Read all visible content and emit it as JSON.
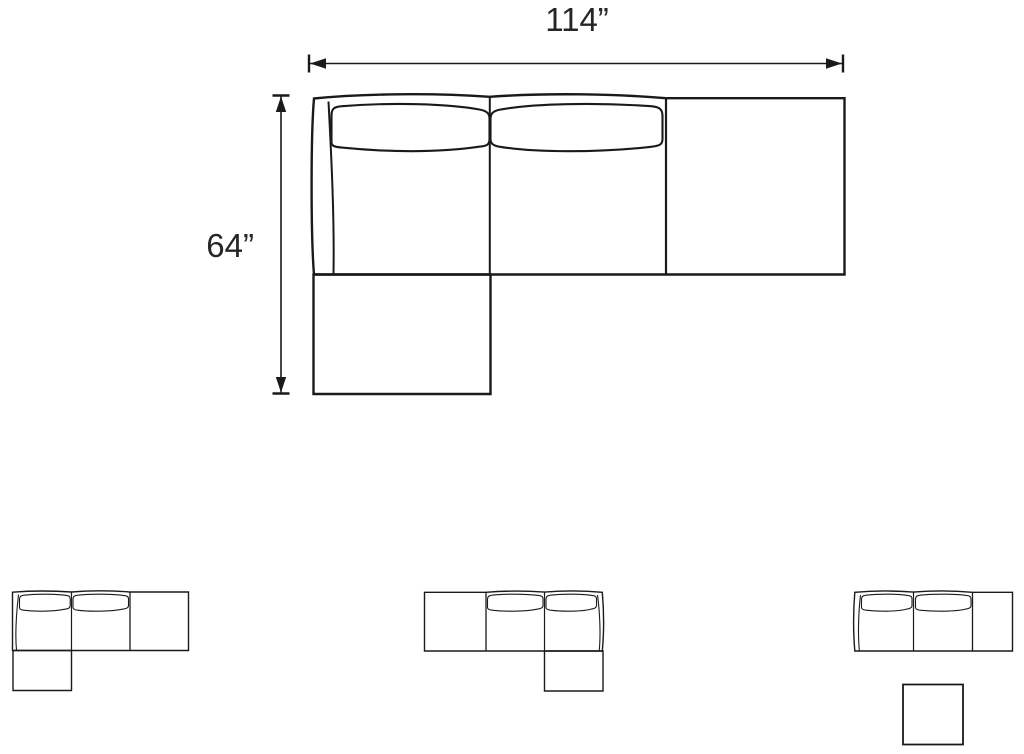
{
  "colors": {
    "line": "#1a1a1a",
    "text": "#262626",
    "background": "#ffffff"
  },
  "main_diagram": {
    "width_label": "114”",
    "height_label": "64”"
  },
  "thumbnails": [
    {
      "id": "sectional-chaise-left"
    },
    {
      "id": "sectional-chaise-right"
    },
    {
      "id": "sofa-with-ottoman"
    }
  ]
}
